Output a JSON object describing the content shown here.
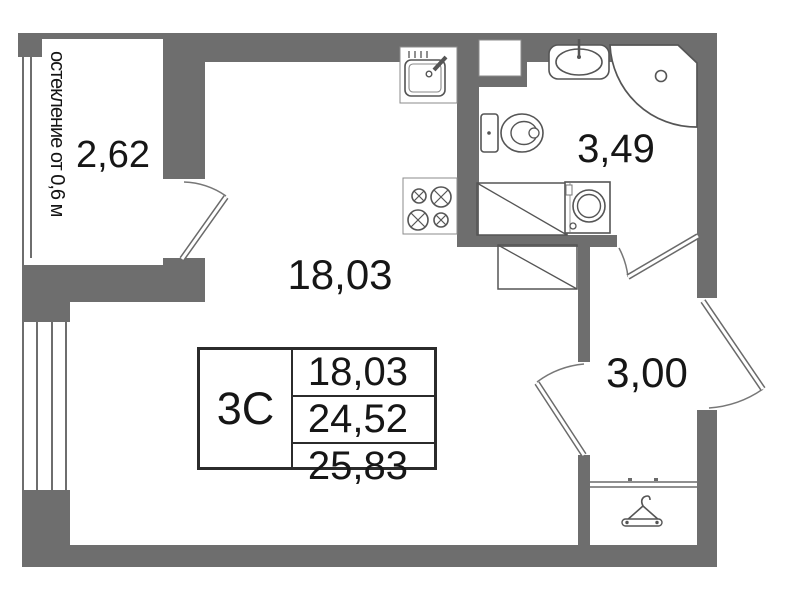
{
  "plan": {
    "legend": {
      "unit_type": "3С",
      "areas": [
        "18,03",
        "24,52",
        "25,83"
      ]
    },
    "rooms": {
      "balcony": {
        "area": "2,62",
        "glazing_note": "остекление от 0,6 м"
      },
      "living_room": {
        "area": "18,03"
      },
      "bathroom": {
        "area": "3,49"
      },
      "hallway": {
        "area": "3,00"
      }
    },
    "icons": {
      "kitchen-sink-icon": "kitchen sink with faucet",
      "stove-icon": "4-burner stove",
      "bathroom-sink-icon": "washbasin with tap",
      "corner-shower-icon": "corner shower pan with drain",
      "toilet-icon": "toilet with tank",
      "washing-machine-icon": "washing machine",
      "hanger-icon": "clothes hanger (closet)"
    },
    "colors": {
      "wall": "#6e6e6e",
      "fixture_line": "#555555",
      "text": "#161616",
      "background": "#ffffff"
    }
  }
}
